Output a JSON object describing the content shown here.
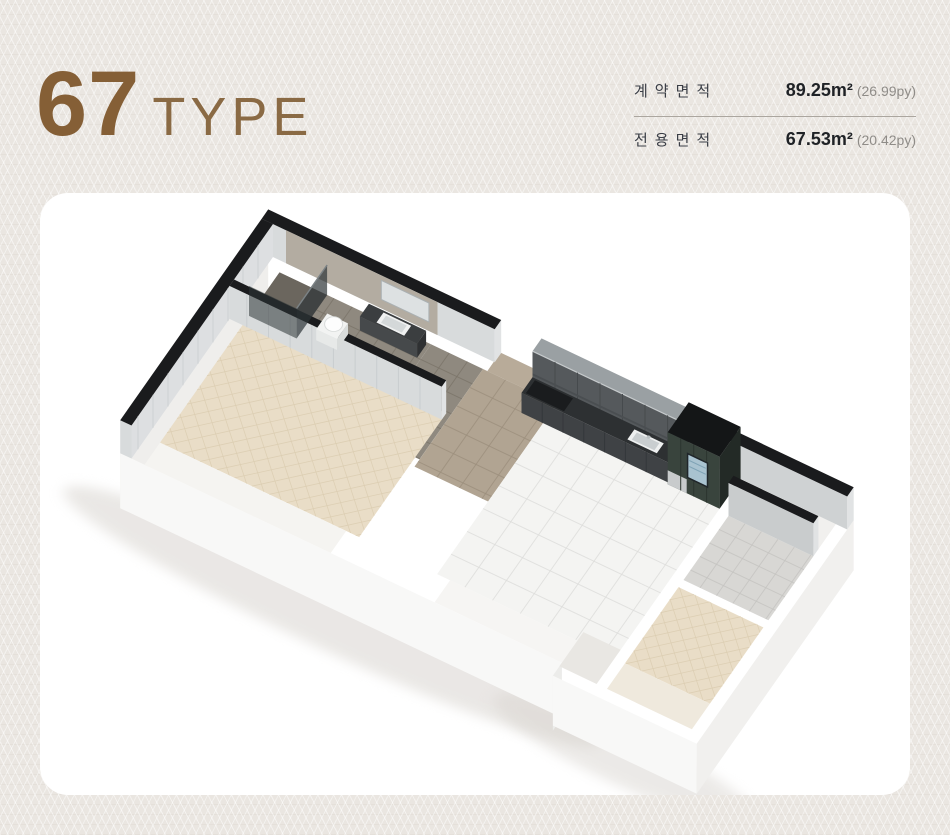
{
  "header": {
    "number": "67",
    "type_label": "TYPE"
  },
  "area_table": {
    "rows": [
      {
        "label": "계약면적",
        "value": "89.25m²",
        "sub": "(26.99py)"
      },
      {
        "label": "전용면적",
        "value": "67.53m²",
        "sub": "(20.42py)"
      }
    ]
  },
  "floorplan": {
    "kind": "isometric 3D apartment render",
    "rooms": [
      "bathroom 1 with shower and basin",
      "bedroom 1 with herringbone wood floor",
      "entry hall with marble floor",
      "living-kitchen with marble tile floor",
      "bathroom 2 with toilet and vanity",
      "bedroom 2 with teal accent wall",
      "balconies with glass window walls",
      "utility nook with washing machine"
    ],
    "features": [
      "black cut-wall tops",
      "dark gray kitchen cabinet run with sink",
      "green refrigerator unit with display panel",
      "kitchen island with red induction burners and wine rack",
      "open entrance door leaf",
      "white building plinth"
    ]
  },
  "colors": {
    "accent_brown": "#8a6a44",
    "page_bg": "#eae6e1",
    "card_bg": "#ffffff",
    "wall_cut": "#1a1b1d",
    "wood_floor": "#e9ddc7",
    "marble_floor": "#f4f4f2",
    "kitchen_dark": "#3f4245",
    "teal_wall": "#8ba0a2",
    "label_text": "#3a3e46",
    "value_text": "#1f2226",
    "sub_text": "#8f8c88"
  }
}
